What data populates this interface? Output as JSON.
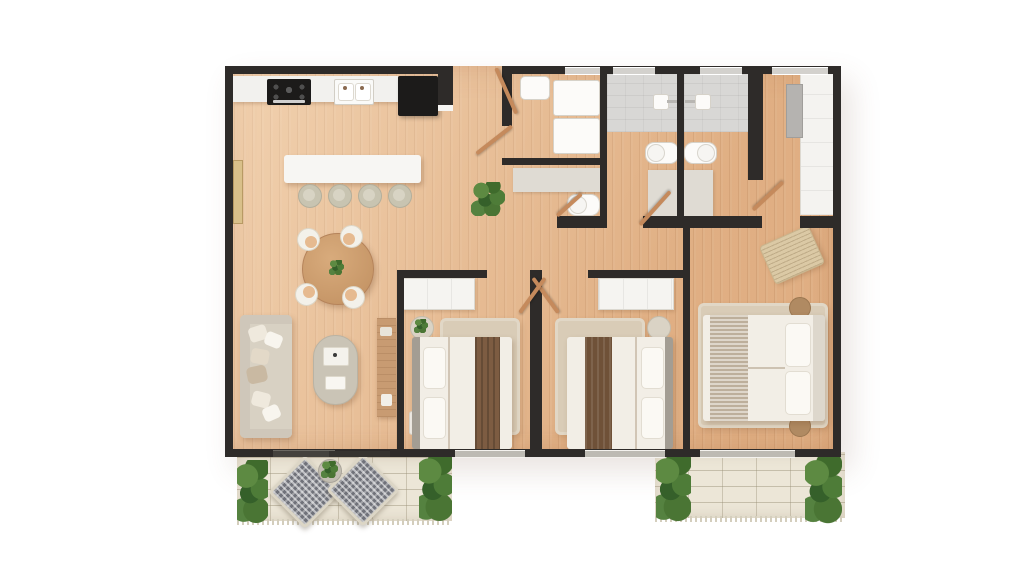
{
  "title": "3-bedroom apartment floor plan – top-down 3D render",
  "visible_text": [],
  "colors": {
    "wall": "#2e2b29",
    "floor": "#e6ba90",
    "counter": "#f2f1ee",
    "appliance": "#1c1b1a",
    "island": "#f7f6f3",
    "stool": "#c8c4b1",
    "sofa": "#d8d1c3",
    "rug": "#d9ccb7",
    "table_wood": "#cfa077",
    "console_wood": "#c89b72",
    "bed_white": "#f2eee6",
    "runner": "#7d5c42",
    "master_runner": "#ccc0ae",
    "headboard": "#a39d93",
    "shower": "#d8d7d5",
    "vanity": "#dfdbd3",
    "fixture": "#fcfbf9",
    "wardrobe": "#f4f3f0",
    "patio_tile": "#ece6d7",
    "patio_chair": "#70727a",
    "plant": "#4a7534",
    "door_leaf": "#c58a5c",
    "window_glass": "#d3d1cd",
    "sliding_door": "#35332f",
    "background": "#ffffff"
  },
  "rooms": [
    {
      "name": "kitchen",
      "furniture": [
        "counter",
        "gas-cooktop",
        "double-sink",
        "refrigerator",
        "island",
        "bar-stool x4"
      ]
    },
    {
      "name": "dining-area",
      "furniture": [
        "round-wood-table",
        "chair x4",
        "table-plant"
      ]
    },
    {
      "name": "living-room",
      "furniture": [
        "sofa-with-pillows",
        "oval-coffee-table",
        "tv-console",
        "sliding-glass-door",
        "wall-mirror"
      ]
    },
    {
      "name": "entry-hall",
      "furniture": [
        "entry-door",
        "floor-plant"
      ]
    },
    {
      "name": "laundry-room",
      "furniture": [
        "utility-sink",
        "stacked-washer-dryer"
      ]
    },
    {
      "name": "powder-room",
      "furniture": [
        "vanity-sink",
        "toilet"
      ]
    },
    {
      "name": "bathroom-1",
      "furniture": [
        "shower",
        "toilet",
        "vanity-sink"
      ]
    },
    {
      "name": "bathroom-2",
      "furniture": [
        "shower",
        "toilet",
        "vanity-sink"
      ]
    },
    {
      "name": "walk-in-closet",
      "furniture": [
        "wardrobe",
        "dresser-panel"
      ]
    },
    {
      "name": "bedroom-1",
      "furniture": [
        "double-bed",
        "wardrobe",
        "round-nightstand",
        "side-table",
        "rug"
      ]
    },
    {
      "name": "bedroom-2",
      "furniture": [
        "double-bed",
        "wardrobe",
        "round-nightstand",
        "side-table",
        "rug"
      ]
    },
    {
      "name": "master-bedroom",
      "furniture": [
        "king-bed",
        "woven-bench",
        "pouf x2",
        "rug"
      ]
    },
    {
      "name": "patio-left",
      "furniture": [
        "lounge-chair x2",
        "planter",
        "shrub x2",
        "stone-tiles",
        "fringed-rug-edge"
      ]
    },
    {
      "name": "patio-right",
      "furniture": [
        "shrub x2",
        "stone-tiles",
        "fringed-rug-edge"
      ]
    }
  ]
}
